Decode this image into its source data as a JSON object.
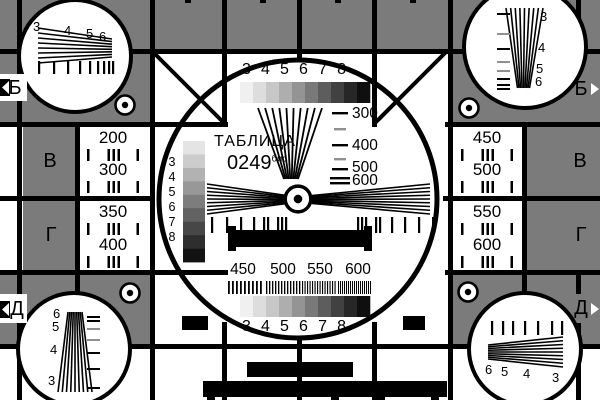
{
  "card": {
    "title": "ТАБЛИЦА",
    "code": "0249",
    "code_suffix": "бис"
  },
  "colors": {
    "background": "#ffffff",
    "gray": "#7b7b7b",
    "line": "#000000"
  },
  "row_labels": {
    "left": [
      "Б",
      "В",
      "Г",
      "Д"
    ],
    "right": [
      "Б",
      "В",
      "Г",
      "Д"
    ]
  },
  "side_cells": {
    "left_top": {
      "line1": "200",
      "line2": "300"
    },
    "left_bottom": {
      "line1": "350",
      "line2": "400"
    },
    "right_top": {
      "line1": "450",
      "line2": "500"
    },
    "right_bottom": {
      "line1": "550",
      "line2": "600"
    }
  },
  "center": {
    "top_scale_digits": [
      "3",
      "4",
      "5",
      "6",
      "7",
      "8"
    ],
    "bottom_scale_digits": [
      "3",
      "4",
      "5",
      "6",
      "7",
      "8"
    ],
    "vertical_wedge_labels": [
      "300",
      "400",
      "500",
      "600"
    ],
    "frequency_labels": [
      "450",
      "500",
      "550",
      "600"
    ],
    "gray_column_digits": [
      "3",
      "4",
      "5",
      "6",
      "7",
      "8"
    ]
  },
  "corner_circles": {
    "top_left": [
      "3",
      "4",
      "5",
      "6"
    ],
    "top_right": [
      "3",
      "4",
      "5",
      "6"
    ],
    "bottom_left": [
      "6",
      "5",
      "4",
      "3"
    ],
    "bottom_right": [
      "6",
      "5",
      "4",
      "3"
    ]
  },
  "grayscale": {
    "horizontal_steps": [
      "#f0f0f0",
      "#dddddd",
      "#c7c7c7",
      "#aeaeae",
      "#949494",
      "#797979",
      "#5d5d5d",
      "#414141",
      "#272727",
      "#0f0f0f"
    ],
    "vertical_steps": [
      "#e4e4e4",
      "#cccccc",
      "#b2b2b2",
      "#989898",
      "#7d7d7d",
      "#626262",
      "#474747",
      "#2e2e2e",
      "#131313"
    ]
  },
  "gratings": {
    "pitches": [
      4,
      3,
      2.5,
      2
    ]
  }
}
